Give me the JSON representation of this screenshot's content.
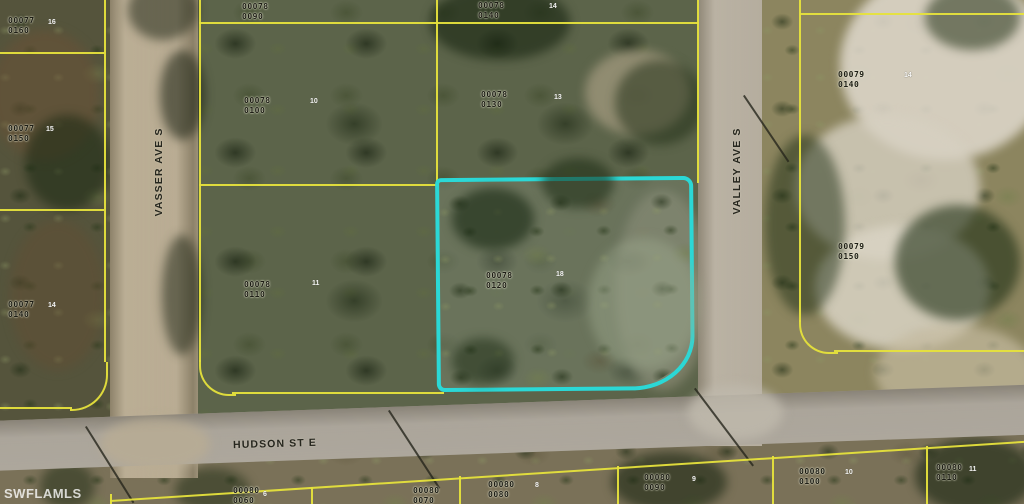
{
  "watermark": "SWFLAMLS",
  "streets": {
    "vasser": "VASSER AVE S",
    "valley": "VALLEY AVE S",
    "hudson": "HUDSON ST E"
  },
  "highlight": {
    "parcel": "00078 0120",
    "outline_color": "#2bd8d6"
  },
  "colors": {
    "parcel_line": "#e6e23c",
    "vegetation_dark": "#4e5538",
    "road_dirt": "#b9ac93",
    "road_paved": "#a8a298",
    "sand": "#d9d3c4"
  },
  "parcel_labels": [
    {
      "line1": "00077",
      "line2": "0160",
      "x": 8,
      "y": 16
    },
    {
      "line1": "00077",
      "line2": "0150",
      "x": 8,
      "y": 124
    },
    {
      "line1": "00077",
      "line2": "0140",
      "x": 8,
      "y": 300
    },
    {
      "line1": "00078",
      "line2": "0090",
      "x": 242,
      "y": 2
    },
    {
      "line1": "00078",
      "line2": "0100",
      "x": 244,
      "y": 96
    },
    {
      "line1": "00078",
      "line2": "0110",
      "x": 244,
      "y": 280
    },
    {
      "line1": "00078",
      "line2": "0140",
      "x": 478,
      "y": 1
    },
    {
      "line1": "00078",
      "line2": "0130",
      "x": 481,
      "y": 90
    },
    {
      "line1": "00078",
      "line2": "0120",
      "x": 486,
      "y": 271
    },
    {
      "line1": "00079",
      "line2": "0140",
      "x": 838,
      "y": 70
    },
    {
      "line1": "00079",
      "line2": "0150",
      "x": 838,
      "y": 242
    },
    {
      "line1": "00080",
      "line2": "0060",
      "x": 233,
      "y": 486
    },
    {
      "line1": "00080",
      "line2": "0070",
      "x": 413,
      "y": 486
    },
    {
      "line1": "00080",
      "line2": "0080",
      "x": 488,
      "y": 480
    },
    {
      "line1": "00080",
      "line2": "0090",
      "x": 644,
      "y": 473
    },
    {
      "line1": "00080",
      "line2": "0100",
      "x": 799,
      "y": 467
    },
    {
      "line1": "00080",
      "line2": "0110",
      "x": 936,
      "y": 463
    }
  ],
  "lot_marks": [
    {
      "value": "16",
      "x": 48,
      "y": 19
    },
    {
      "value": "15",
      "x": 46,
      "y": 126
    },
    {
      "value": "14",
      "x": 48,
      "y": 302
    },
    {
      "value": "10",
      "x": 310,
      "y": 98
    },
    {
      "value": "11",
      "x": 312,
      "y": 280
    },
    {
      "value": "14",
      "x": 549,
      "y": 3
    },
    {
      "value": "13",
      "x": 554,
      "y": 94
    },
    {
      "value": "18",
      "x": 556,
      "y": 271
    },
    {
      "value": "14",
      "x": 904,
      "y": 72
    },
    {
      "value": "6",
      "x": 263,
      "y": 491
    },
    {
      "value": "8",
      "x": 535,
      "y": 482
    },
    {
      "value": "9",
      "x": 692,
      "y": 476
    },
    {
      "value": "10",
      "x": 845,
      "y": 469
    },
    {
      "value": "11",
      "x": 969,
      "y": 466
    }
  ]
}
